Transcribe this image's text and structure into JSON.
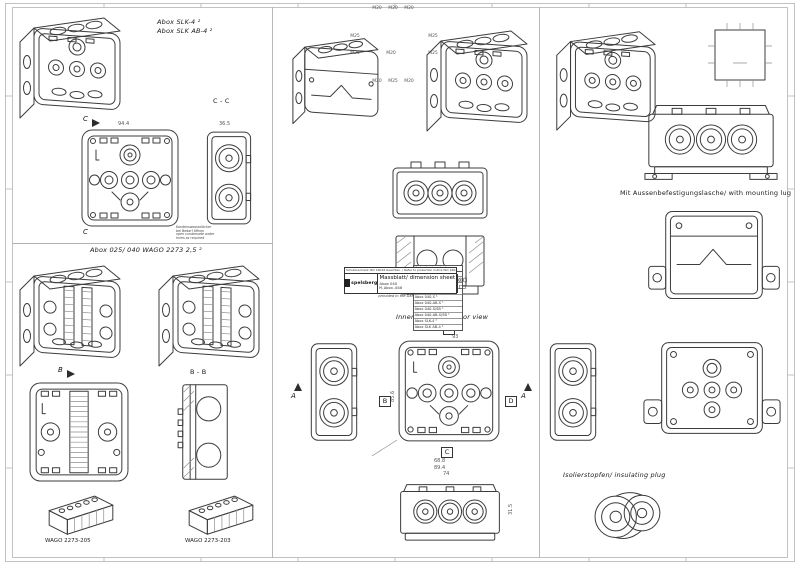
{
  "captions": {
    "abox_slk": "Abox SLK-4 ²",
    "abox_slk_ab": "Abox SLK AB-4 ²",
    "abox_wago": "Abox 025/ 040 WAGO 2273 2,5 ²",
    "interior_view": "Innenansicht/ interior view",
    "mounting_lug": "Mit Aussenbefestigungslasche/ with mounting lug",
    "insulating_plug": "Isolierstopfen/ insulating plug",
    "wago_205": "WAGO 2273-205",
    "wago_203": "WAGO 2273-203"
  },
  "sections": {
    "cc": "C - C",
    "bb": "B - B",
    "aa": "A - A",
    "a": "A",
    "b": "B",
    "c": "C",
    "d": "D"
  },
  "knockout_plan": {
    "top": [
      "M20",
      "M20",
      "M20"
    ],
    "left": [
      "M25",
      "M25"
    ],
    "right": [
      "M25",
      "M25"
    ],
    "bottom": [
      "M20",
      "M25",
      "M20"
    ],
    "center": "M20"
  },
  "dims": {
    "front_width": "94.4",
    "side_depth": "36.5",
    "interior_width": "93",
    "interior_height": "85.6",
    "bottom_inner": "68.8",
    "bottom_outer": "89.4",
    "lug_width": "74",
    "lug_height": "31.5"
  },
  "notes": {
    "dxf_de": "Fehlende Maße können dem DXF entnommen werden.",
    "dxf_en": "missing dimensions are provided in the DXF",
    "condensate_de1": "Kondenswasserlöcher",
    "condensate_de2": "bei Bedarf öffnen",
    "condensate_en1": "open condensate water",
    "condensate_en2": "holes as required"
  },
  "variants": {
    "header": "Varianten/ variants",
    "rows": [
      "Abox 040-L",
      "Abox 040-L/SB",
      "Abox 040-AB-L",
      "Abox 040-AB-L/SB",
      "Abox 040-S ¹",
      "Abox 040-AB-S ¹",
      "Abox 040-S/SB ¹",
      "Abox 040-AB-S/SB ¹",
      "Abox SLK-4 ²",
      "Abox SLK AB-4 ²"
    ]
  },
  "title_block": {
    "protection_notice": "Schutzvermerk ISO 16016 beachten. / Refer to protection notice ISO 16016.",
    "scale": "Maßstab 1:1",
    "logo": "spelsberg",
    "doc_title": "Massblatt/ dimension sheet",
    "product": "Abox 040",
    "doc_number": "M-Abox-040"
  }
}
